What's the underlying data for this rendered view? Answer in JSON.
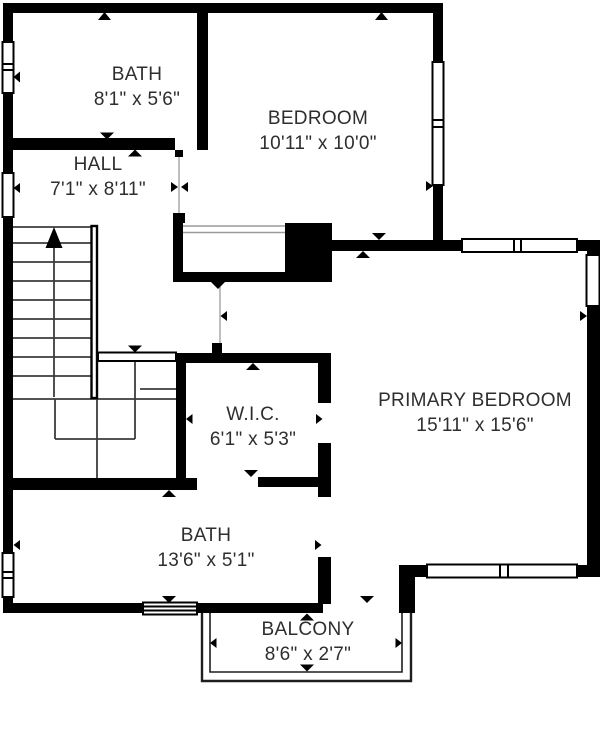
{
  "plan": {
    "rooms": {
      "bath_upper": {
        "name": "BATH",
        "dims": "8'1\" x 5'6\""
      },
      "hall": {
        "name": "HALL",
        "dims": "7'1\" x 8'11\""
      },
      "bedroom": {
        "name": "BEDROOM",
        "dims": "10'11\" x 10'0\""
      },
      "primary_bedroom": {
        "name": "PRIMARY BEDROOM",
        "dims": "15'11\" x 15'6\""
      },
      "wic": {
        "name": "W.I.C.",
        "dims": "6'1\" x 5'3\""
      },
      "bath_lower": {
        "name": "BATH",
        "dims": "13'6\" x 5'1\""
      },
      "balcony": {
        "name": "BALCONY",
        "dims": "8'6\" x 2'7\""
      }
    },
    "colors": {
      "wall": "#000000",
      "text": "#2e2e2e",
      "background": "#ffffff"
    }
  }
}
